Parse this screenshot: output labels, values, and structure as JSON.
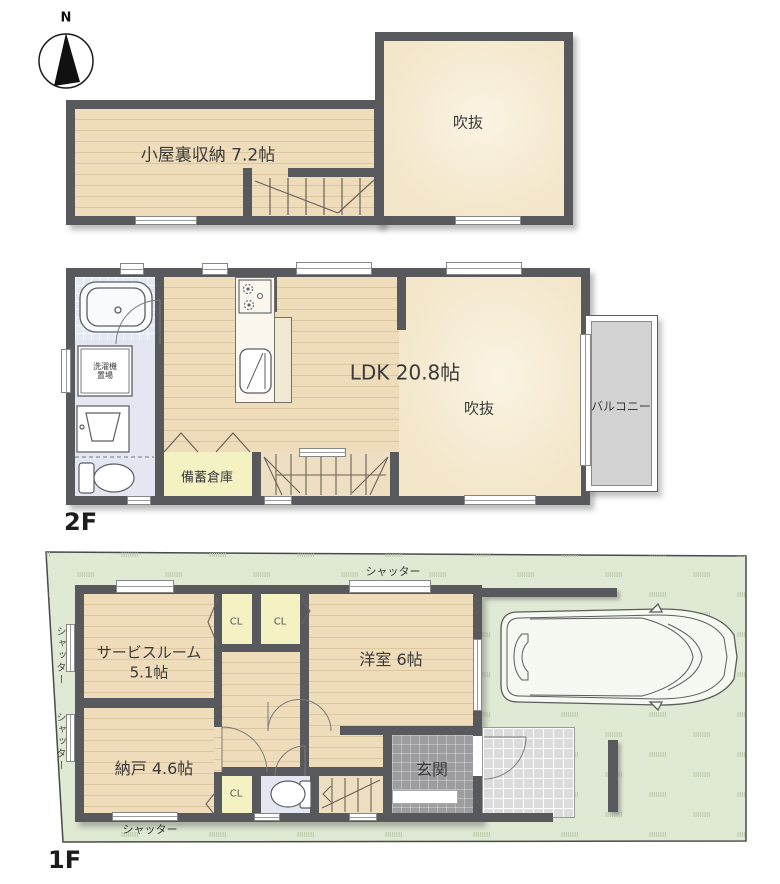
{
  "compass": {
    "north": "N"
  },
  "attic": {
    "storage_room": "小屋裏収納 7.2帖",
    "void": "吹抜"
  },
  "floor2": {
    "label": "2F",
    "ldk": "LDK 20.8帖",
    "void": "吹抜",
    "balcony": "バルコニー",
    "stock_room": "備蓄倉庫",
    "laundry": "洗濯機置場"
  },
  "floor1": {
    "label": "1F",
    "service_room_name": "サービスルーム",
    "service_room_size": "5.1帖",
    "western_room": "洋室 6帖",
    "storage_room": "納戸 4.6帖",
    "closet": "CL",
    "entrance": "玄関",
    "shutter": "シャッター"
  },
  "palette": {
    "wall": "#57595d",
    "wood_floor": "#ecdab8",
    "void_cream": "#f5ecd4",
    "closet_yellow": "#f4f1c3",
    "site_green": "#e0e9d3",
    "balcony_gray": "#d2d2d2",
    "entrance_gray": "#9d9da0",
    "bath_blue": "#e3e8f1"
  }
}
